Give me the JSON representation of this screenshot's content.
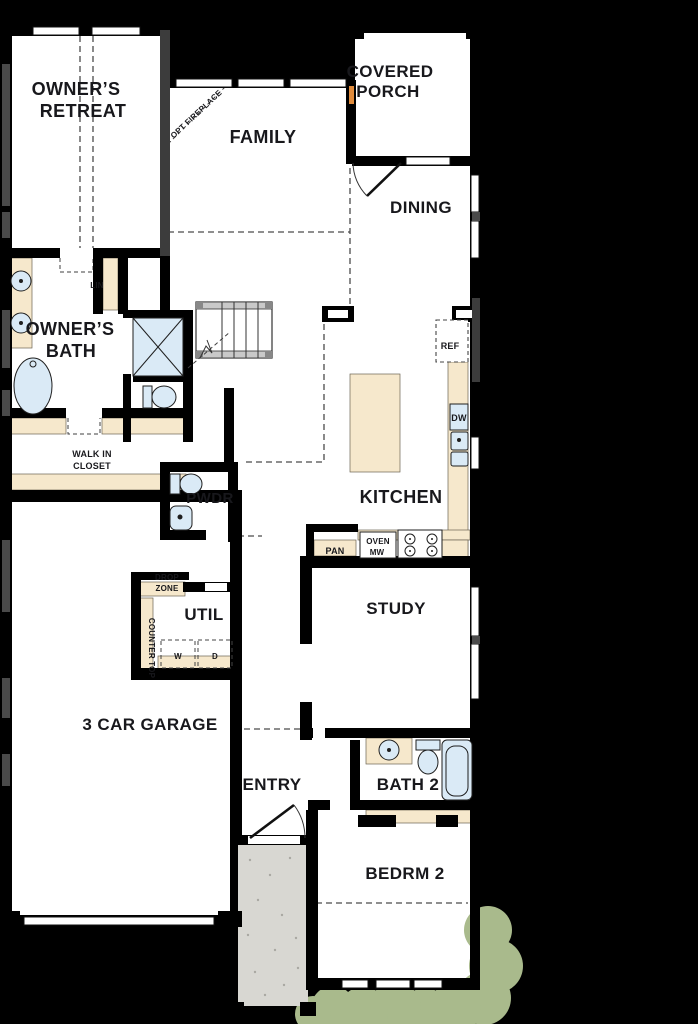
{
  "plan_title": "single-story floor plan",
  "colors": {
    "wall": "#000000",
    "wall_gray": "#3c3c3c",
    "floor": "#ffffff",
    "counter": "#f6e8cc",
    "fixture": "#daeaf6",
    "stoop": "#d8d7d2",
    "shrub": "#a9ba8c",
    "glass_dark": "#4a4a4a",
    "text": "#18181c",
    "accent_orange": "#e08b3c",
    "stair_gray": "#c9c9c9"
  },
  "labels": {
    "owners_retreat_1": "OWNER’S",
    "owners_retreat_2": "RETREAT",
    "covered_porch_1": "COVERED",
    "covered_porch_2": "PORCH",
    "family": "FAMILY",
    "dining": "DINING",
    "owners_bath_1": "OWNER’S",
    "owners_bath_2": "BATH",
    "lin": "LIN",
    "walk_in_closet_1": "WALK IN",
    "walk_in_closet_2": "CLOSET",
    "pwdr": "PWDR",
    "kitchen": "KITCHEN",
    "ref": "REF",
    "dw": "DW",
    "pan": "PAN",
    "oven": "OVEN",
    "mw": "MW",
    "study": "STUDY",
    "drop_zone_1": "DROP",
    "drop_zone_2": "ZONE",
    "util": "UTIL",
    "washer": "W",
    "dryer": "D",
    "counter_top": "COUNTER TOP",
    "garage": "3 CAR GARAGE",
    "entry": "ENTRY",
    "bath2": "BATH 2",
    "bedrm2": "BEDRM 2",
    "opt_fireplace": "OPT FIREPLACE"
  }
}
